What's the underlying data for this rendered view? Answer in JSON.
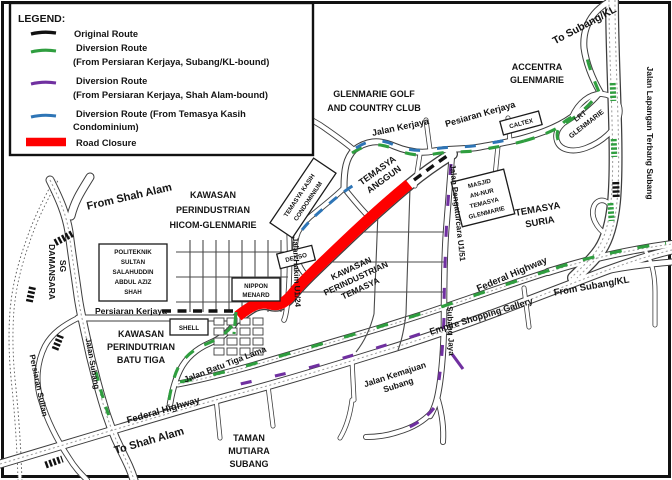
{
  "colors": {
    "route_green": "#2f9e3f",
    "route_purple": "#7030a0",
    "route_blue": "#2e75b6",
    "road_closure": "#fe0000",
    "route_black": "#111111"
  },
  "legend": {
    "title": "LEGEND:",
    "items": [
      {
        "line1": "Original Route",
        "line2": ""
      },
      {
        "line1": "Diversion Route",
        "line2": "(From Persiaran Kerjaya, Subang/KL-bound)"
      },
      {
        "line1": "Diversion Route",
        "line2": "(From Persiaran Kerjaya, Shah Alam-bound)"
      },
      {
        "line1": "Diversion Route (From Temasya Kasih",
        "line2": "Condominium)"
      },
      {
        "line1": "Road Closure",
        "line2": ""
      }
    ]
  },
  "map": {
    "labels": {
      "from_shah_alam": "From Shah Alam",
      "hicom_1": "KAWASAN",
      "hicom_2": "PERINDUSTRIAN",
      "hicom_3": "HICOM-GLENMARIE",
      "glen_golf_1": "GLENMARIE GOLF",
      "glen_golf_2": "AND COUNTRY CLUB",
      "accentra_1": "ACCENTRA",
      "accentra_2": "GLENMARIE",
      "to_subang_kl": "To Subang/KL",
      "jalan_lapangan": "Jalan Lapangan Terbang Subang",
      "jalan_kerjaya": "Jalan Kerjaya",
      "pesiaran_kerjaya": "Pesiaran Kerjaya",
      "lrt_1": "LRT",
      "lrt_2": "GLENMARIE",
      "temasya_anggun_1": "TEMASYA",
      "temasya_anggun_2": "ANGGUN",
      "temasya_suria_1": "TEMASYA",
      "temasya_suria_2": "SURIA",
      "masjid_1": "MASJID",
      "masjid_2": "AN-NUR",
      "masjid_3": "TEMASYA",
      "masjid_4": "GLENMARIE",
      "kasih_1": "TEMASYA KASIH",
      "kasih_2": "CONDOMINIUM",
      "denso": "DENSO",
      "nippon_1": "NIPPON",
      "nippon_2": "MENARD",
      "politeknik_1": "POLITEKNIK",
      "politeknik_2": "SULTAN",
      "politeknik_3": "SALAHUDDIN",
      "politeknik_4": "ABDUL AZIZ",
      "politeknik_5": "SHAH",
      "jalan_hakim": "Jalan Hakim U1/24",
      "persiaran_kerjaya_w": "Persiaran Kerjaya",
      "shell": "SHELL",
      "caltex": "CALTEX",
      "batu_tiga_1": "KAWASAN",
      "batu_tiga_2": "PERINDUTRIAN",
      "batu_tiga_3": "BATU TIGA",
      "sg": "SG",
      "damansara": "DAMANSARA",
      "persiaran_sultan": "Persiaran Sultan",
      "jalan_subang": "Jalan Subang",
      "jalan_batu_tiga_lama": "Jalan Batu Tiga Lama",
      "federal_highway_w": "Federal Highway",
      "to_shah_alam": "To Shah Alam",
      "taman_1": "TAMAN",
      "taman_2": "MUTIARA",
      "taman_3": "SUBANG",
      "kawasan_temasya_1": "KAWASAN",
      "kawasan_temasya_2": "PERINDUSTRIAN",
      "kawasan_temasya_3": "TEMASYA",
      "jalan_pengaturcara": "Jalan Pengaturcara U1/51",
      "subang_jaya": "Subang Jaya",
      "kemajuan_1": "Jalan Kemajuan",
      "kemajuan_2": "Subang",
      "federal_highway_e": "Federal Highway",
      "from_subang_kl": "From Subang/KL",
      "empire": "Empire Shopping Gallery"
    }
  }
}
